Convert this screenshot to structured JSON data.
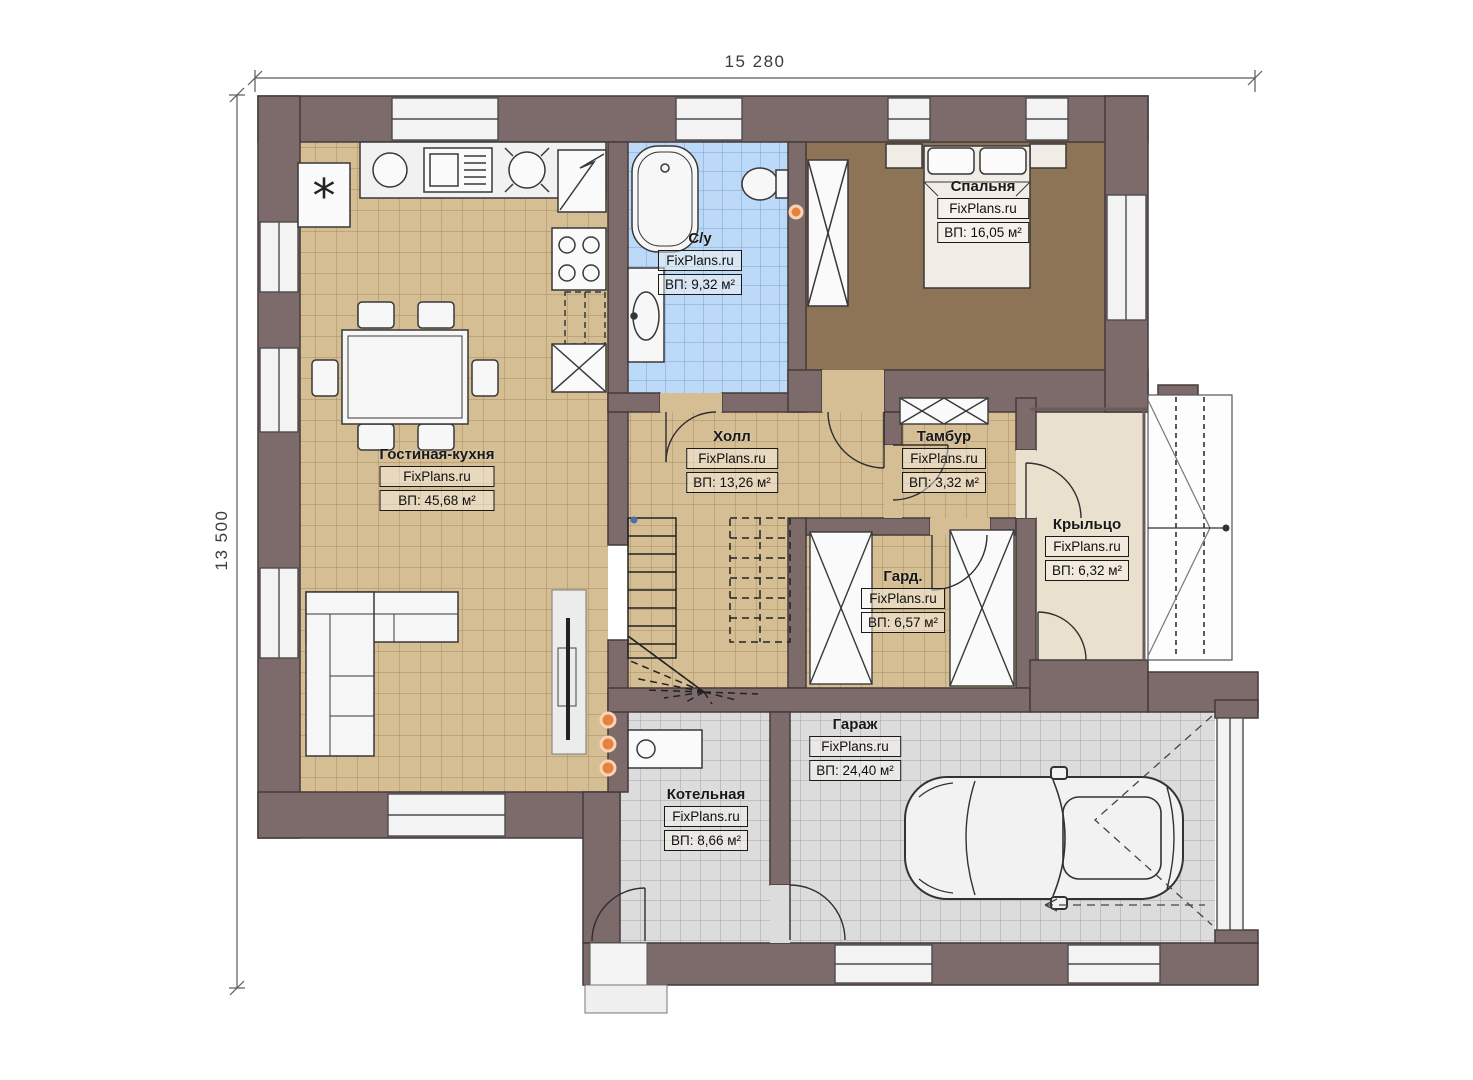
{
  "plan": {
    "type": "floor-plan",
    "dimensions": {
      "width_label": "15 280",
      "height_label": "13 500"
    },
    "brand": "FixPlans.ru",
    "rooms": [
      {
        "id": "living-kitchen",
        "name": "Гостиная-кухня",
        "brand": "FixPlans.ru",
        "area": "ВП: 45,68 м²"
      },
      {
        "id": "bathroom",
        "name": "С/у",
        "brand": "FixPlans.ru",
        "area": "ВП: 9,32 м²"
      },
      {
        "id": "bedroom",
        "name": "Спальня",
        "brand": "FixPlans.ru",
        "area": "ВП: 16,05 м²"
      },
      {
        "id": "hall",
        "name": "Холл",
        "brand": "FixPlans.ru",
        "area": "ВП: 13,26 м²"
      },
      {
        "id": "vestibule",
        "name": "Тамбур",
        "brand": "FixPlans.ru",
        "area": "ВП: 3,32 м²"
      },
      {
        "id": "porch",
        "name": "Крыльцо",
        "brand": "FixPlans.ru",
        "area": "ВП: 6,32 м²"
      },
      {
        "id": "wardrobe",
        "name": "Гард.",
        "brand": "FixPlans.ru",
        "area": "ВП: 6,57 м²"
      },
      {
        "id": "garage",
        "name": "Гараж",
        "brand": "FixPlans.ru",
        "area": "ВП: 24,40 м²"
      },
      {
        "id": "boiler-room",
        "name": "Котельная",
        "brand": "FixPlans.ru",
        "area": "ВП: 8,66 м²"
      }
    ],
    "colors": {
      "wall": "#7d6a6a",
      "floor_tile_tan": "#d5be94",
      "floor_tile_blue": "#bcd9f7",
      "floor_tile_gray": "#dcdcdc",
      "floor_bedroom": "#8d7457",
      "floor_porch": "#e9e1cd",
      "accent_orange": "#e8803f"
    }
  }
}
